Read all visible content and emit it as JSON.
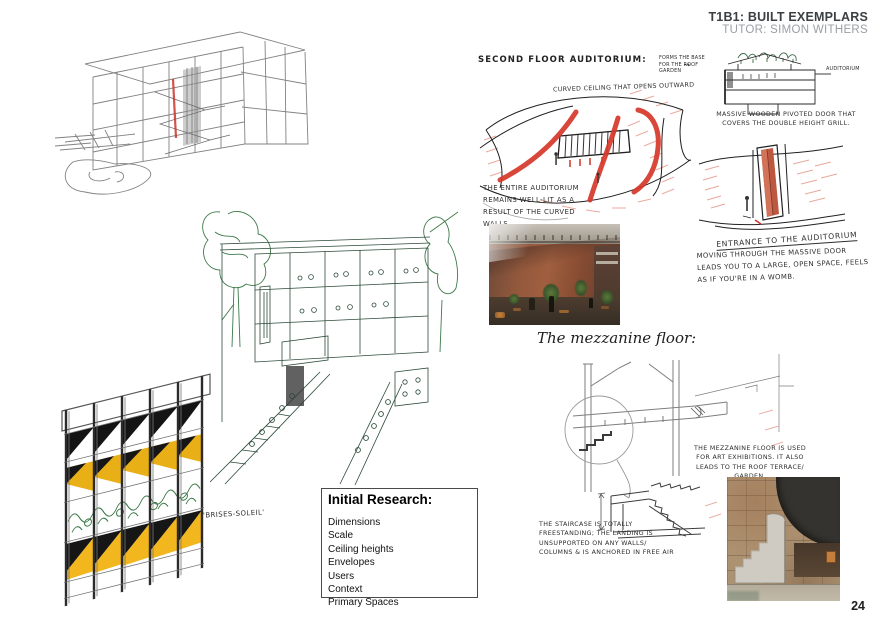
{
  "header": {
    "title": "T1B1: BUILT EXEMPLARS",
    "subtitle": "TUTOR: SIMON WITHERS"
  },
  "page_number": "24",
  "left_column": {
    "brises_label": "'BRISES-SOLEIL'",
    "research_box": {
      "title": "Initial Research:",
      "items": [
        "Dimensions",
        "Scale",
        "Ceiling heights",
        "Envelopes",
        "Users",
        "Context",
        "Primary Spaces"
      ]
    }
  },
  "auditorium": {
    "heading": "SECOND FLOOR AUDITORIUM:",
    "ceiling_note": "CURVED CEILING THAT OPENS OUTWARD",
    "roof_note": "FORMS THE BASE FOR THE ROOF GARDEN",
    "section_label": "AUDITORIUM",
    "arrow": "→",
    "welllit_note": "THE ENTIRE AUDITORIUM REMAINS WELL-LIT AS A RESULT OF THE CURVED WALLS,",
    "door_note": "MASSIVE WOODEN PIVOTED DOOR THAT COVERS THE DOUBLE HEIGHT GRILL.",
    "entrance_heading": "ENTRANCE TO THE AUDITORIUM",
    "entrance_note": "MOVING THROUGH THE MASSIVE DOOR LEADS YOU TO A LARGE, OPEN SPACE, FEELS AS IF YOU'RE IN A WOMB."
  },
  "mezzanine": {
    "heading": "The mezzanine floor:",
    "floor_note": "THE MEZZANINE FLOOR IS USED FOR ART EXHIBITIONS. IT ALSO LEADS TO THE ROOF TERRACE/ GARDEN.",
    "stair_note": "THE STAIRCASE IS TOTALLY FREESTANDING; THE LANDING IS UNSUPPORTED ON ANY WALLS/ COLUMNS & IS ANCHORED IN FREE AIR"
  },
  "colors": {
    "accent_red": "#d6372a",
    "panel_yellow": "#f2b71e",
    "ink_green": "#2c4a38",
    "pencil_gray": "#808080"
  }
}
